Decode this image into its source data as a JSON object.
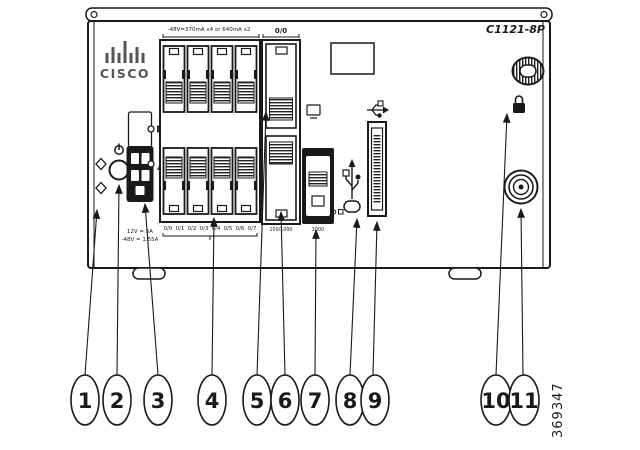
{
  "figure": {
    "model_label": "C1121-8P",
    "figure_id": "369347",
    "brand_logo_text": "CISCO",
    "panel_labels": {
      "poe_rating": "-48V=370mA x4 or 640mA x2",
      "wan_port_id": "0/0",
      "dc_input_line1": "12V = 5A",
      "dc_input_line2": "-48V = 1.55A",
      "wan_speed": "100/1000",
      "sfp_speed": "1000",
      "lan_port_ids": [
        "0/0",
        "0/1",
        "0/2",
        "0/3",
        "0/4",
        "0/5",
        "0/6",
        "0/7"
      ]
    },
    "callouts": [
      {
        "number": "1",
        "target": "ground-connection-point"
      },
      {
        "number": "2",
        "target": "power-button"
      },
      {
        "number": "3",
        "target": "dc-power-input"
      },
      {
        "number": "4",
        "target": "lan-switch-ports"
      },
      {
        "number": "5",
        "target": "wan-ge-port-top"
      },
      {
        "number": "6",
        "target": "wan-ge-port-bottom"
      },
      {
        "number": "7",
        "target": "sfp-port"
      },
      {
        "number": "8",
        "target": "micro-usb-console-port"
      },
      {
        "number": "9",
        "target": "usb-port"
      },
      {
        "number": "10",
        "target": "kensington-lock-slot"
      },
      {
        "number": "11",
        "target": "antenna-connector"
      }
    ],
    "colors": {
      "ink": "#1a1a1a",
      "background": "#ffffff"
    }
  }
}
